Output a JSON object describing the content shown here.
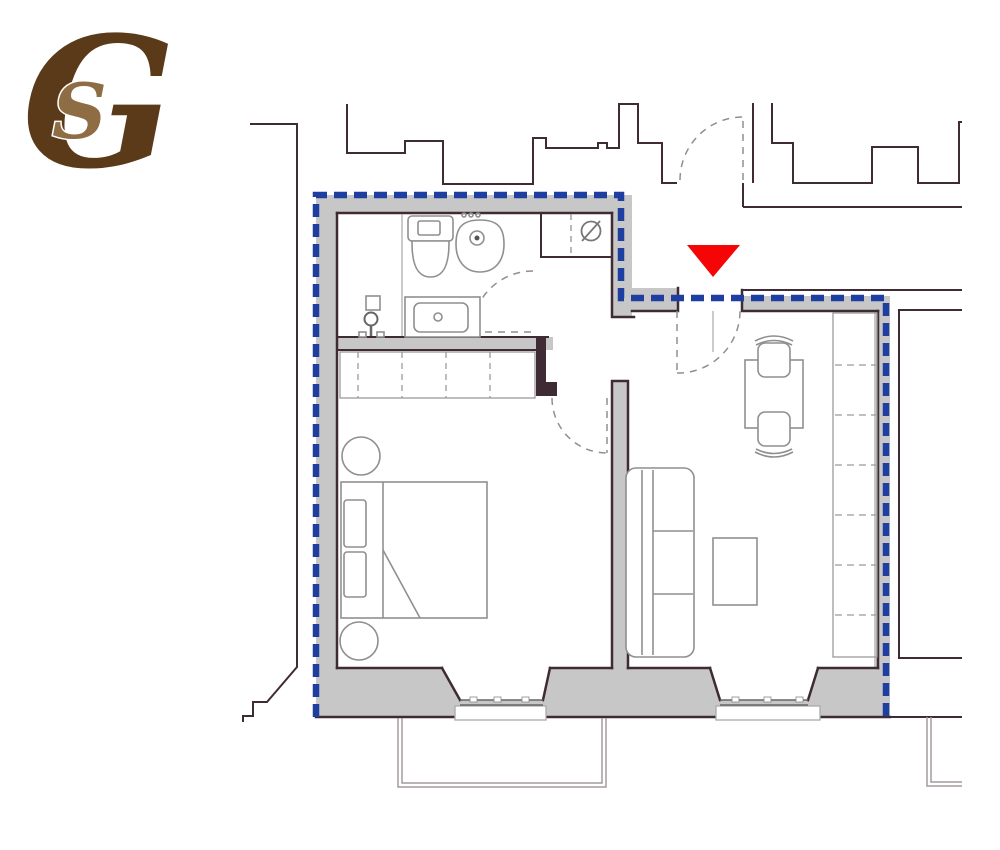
{
  "page": {
    "background": "#ffffff"
  },
  "logo": {
    "outer_letter": "G",
    "inner_letter": "S",
    "outer_color": "#5a3a18",
    "inner_color": "#8e6c44"
  },
  "floor_plan": {
    "colors": {
      "boundary_blue": "#1e3fa0",
      "wall_fill": "#c8c7c7",
      "outline_dark": "#3e2b34",
      "neighbor_line": "#3e2b34",
      "furniture_gray": "#8f8f8f",
      "light_gray": "#a39b9b",
      "marker_red": "#f50505"
    },
    "boiler_symbol": "Ø",
    "entrance_marker": {
      "shape": "triangle-down",
      "color": "#f50505"
    },
    "boundary_style": {
      "dash": "13 7",
      "width": 6.5
    },
    "symbols": [
      {
        "name": "toilet"
      },
      {
        "name": "bidet"
      },
      {
        "name": "washbasin"
      },
      {
        "name": "faucet"
      },
      {
        "name": "boiler"
      },
      {
        "name": "shower-closet"
      },
      {
        "name": "bed"
      },
      {
        "name": "pillows"
      },
      {
        "name": "bedside-table"
      },
      {
        "name": "bedroom-wardrobe"
      },
      {
        "name": "dining-table"
      },
      {
        "name": "chair"
      },
      {
        "name": "sofa"
      },
      {
        "name": "coffee-table"
      },
      {
        "name": "living-wardrobe"
      },
      {
        "name": "door-swing"
      },
      {
        "name": "window"
      },
      {
        "name": "balcony"
      },
      {
        "name": "entrance-marker"
      }
    ]
  }
}
